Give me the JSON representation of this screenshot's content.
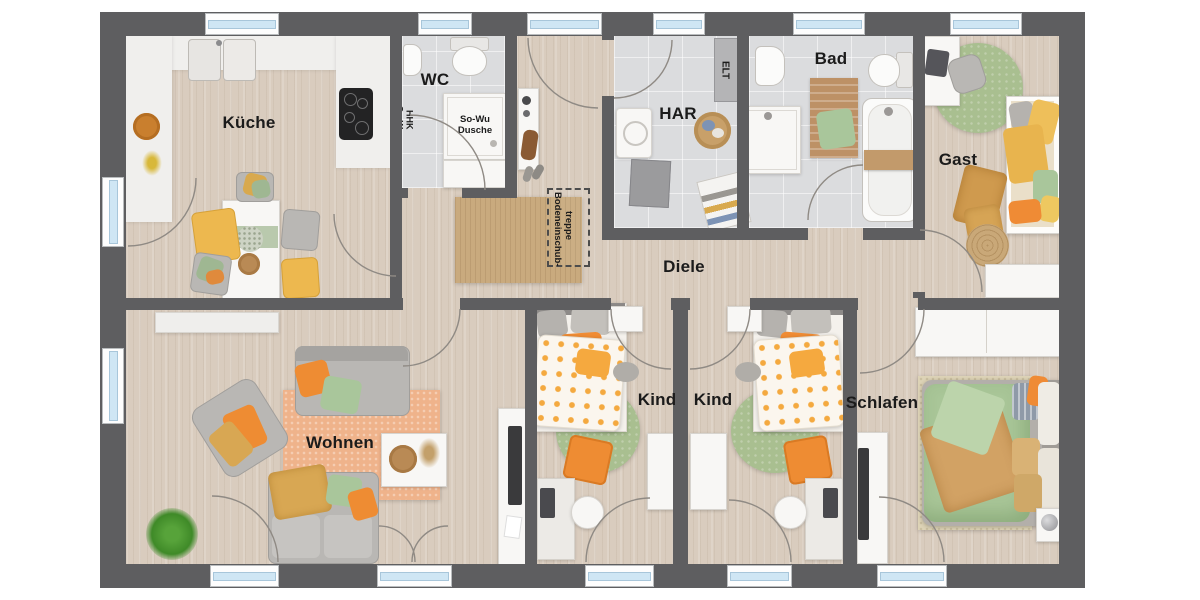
{
  "meta": {
    "kind": "furnished-floor-plan",
    "orientation": "top-down"
  },
  "rooms": [
    {
      "id": "kueche",
      "label": "Küche"
    },
    {
      "id": "wc",
      "label": "WC"
    },
    {
      "id": "har",
      "label": "HAR"
    },
    {
      "id": "bad",
      "label": "Bad"
    },
    {
      "id": "gast",
      "label": "Gast"
    },
    {
      "id": "diele",
      "label": "Diele"
    },
    {
      "id": "wohnen",
      "label": "Wohnen"
    },
    {
      "id": "kind1",
      "label": "Kind"
    },
    {
      "id": "kind2",
      "label": "Kind"
    },
    {
      "id": "schlafen",
      "label": "Schlafen"
    }
  ],
  "annotations": {
    "elt": "ELT",
    "sowu_hhk": {
      "line1": "So-Wu",
      "line2": "HHK"
    },
    "shower": {
      "line1": "So-Wu",
      "line2": "Dusche"
    },
    "attic_stairs": {
      "line1": "Bodeneinschub-",
      "line2": "treppe"
    }
  },
  "colors": {
    "wall": "#5e5e60",
    "wood_floor": "#d9ccbe",
    "tile_floor": "#dbdcde",
    "window_glass": "#cfe6f4",
    "accent_orange": "#ee8c33",
    "accent_green": "#a9bf90",
    "accent_yellow": "#edb84f",
    "rug_peach": "#efb38b",
    "rug_jute": "#c9aa7e"
  }
}
